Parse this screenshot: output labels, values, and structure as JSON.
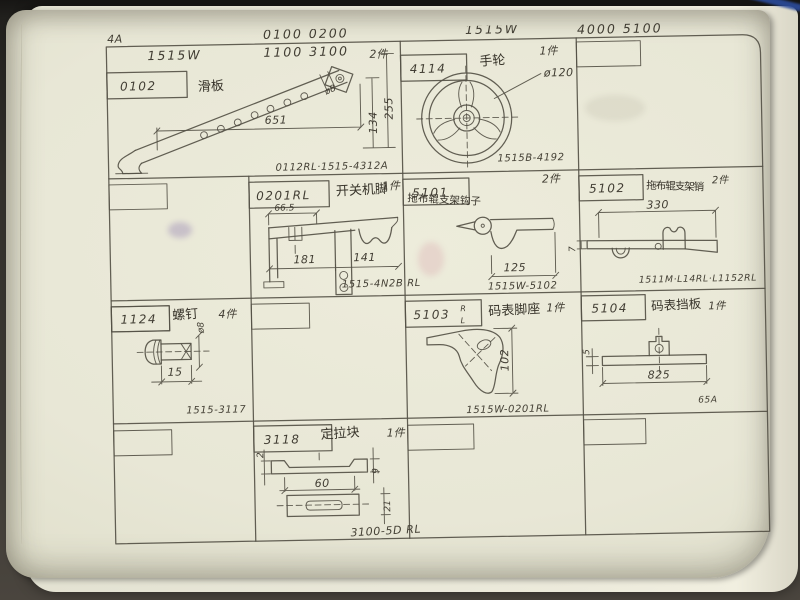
{
  "page_number": "4A",
  "headers": {
    "left_models_top": "0100    0200",
    "left_models_bottom": "1100    3100",
    "left_machine": "1515W",
    "right_machine": "1515W",
    "right_models": "4000    5100"
  },
  "cells": {
    "c0102": {
      "no": "0102",
      "label": "滑板",
      "qty": "2件",
      "dim_length": "651",
      "dim_h1": "134",
      "dim_h2": "255",
      "dim_hole": "ø8",
      "code": "0112RL·1515-4312A"
    },
    "c4114": {
      "no": "4114",
      "label": "手轮",
      "qty": "1件",
      "dim_dia": "ø120",
      "code": "1515B-4192"
    },
    "c0201": {
      "no": "0201RL",
      "label": "开关机脚",
      "qty": "1件",
      "dim_a": "66.5",
      "dim_b": "181",
      "dim_c": "141",
      "code": "1515-4N2B RL"
    },
    "c5101": {
      "no": "5101",
      "label": "拖布辊支架钩子",
      "qty": "2件",
      "dim_a": "125",
      "code": "1515W-5102"
    },
    "c5102": {
      "no": "5102",
      "label": "拖布辊支架销",
      "qty": "2件",
      "dim_a": "330",
      "dim_b": "7",
      "code": "1511M·L14RL·L1152RL"
    },
    "c1124": {
      "no": "1124",
      "label": "螺钉",
      "qty": "4件",
      "dim_a": "15",
      "dim_b": "ø8",
      "code": "1515-3117"
    },
    "c5103": {
      "no": "5103",
      "no_r": "R",
      "no_l": "L",
      "label": "码表脚座",
      "qty": "1件",
      "dim_a": "102",
      "code": "1515W-0201RL"
    },
    "c5104": {
      "no": "5104",
      "label": "码表挡板",
      "qty": "1件",
      "dim_a": "825",
      "dim_b": "5",
      "code": "65A"
    },
    "c3118": {
      "no": "3118",
      "label": "定拉块",
      "qty": "1件",
      "dim_a": "60",
      "dim_b": "9",
      "dim_c": "21",
      "dim_d": "2",
      "code": "3100-5D RL"
    }
  }
}
